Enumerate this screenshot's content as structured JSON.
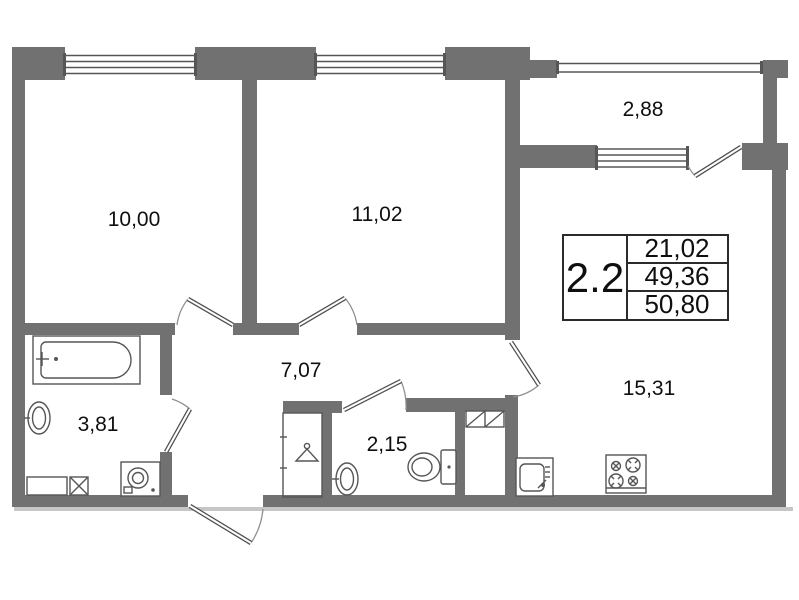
{
  "plan": {
    "title": "apartment-floor-plan",
    "info_box": {
      "type_label": "2.2",
      "rows": [
        "21,02",
        "49,36",
        "50,80"
      ]
    },
    "rooms": {
      "bedroom1": "10,00",
      "bedroom2": "11,02",
      "balcony": "2,88",
      "hallway": "7,07",
      "bathroom": "3,81",
      "wc": "2,15",
      "kitchen_living": "15,31"
    }
  },
  "colors": {
    "wall": "#717171",
    "line": "#565656",
    "text": "#0f0f0f"
  }
}
